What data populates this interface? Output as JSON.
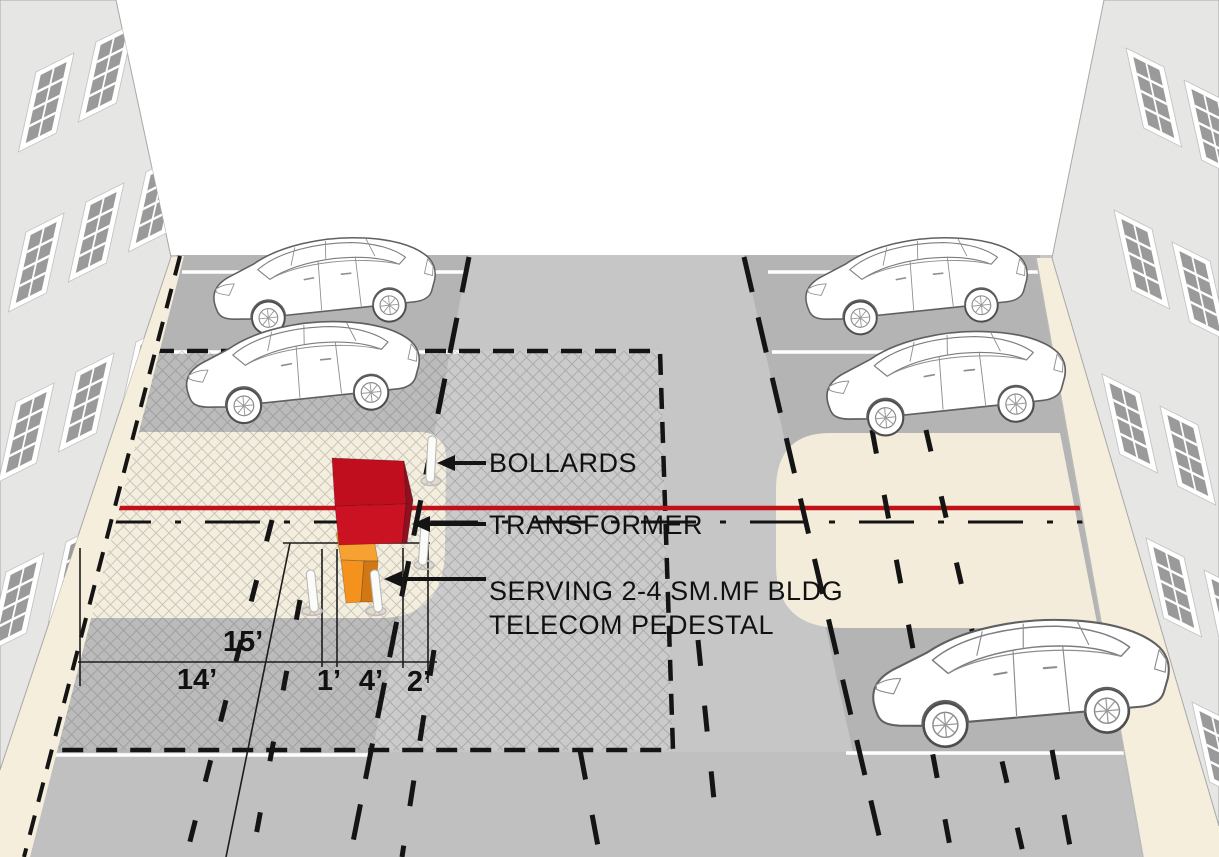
{
  "diagram": {
    "callouts": {
      "bollards": "BOLLARDS",
      "transformer": "TRANSFORMER",
      "pedestal_line1": "SERVING 2-4 SM.MF BLDG",
      "pedestal_line2": "TELECOM PEDESTAL"
    },
    "dimensions": {
      "setback_15": "15’",
      "setback_14": "14’",
      "offset_1": "1’",
      "offset_4": "4’",
      "offset_2": "2’"
    },
    "colors": {
      "transformer_top": "#c00e1f",
      "transformer_front": "#ca1222",
      "transformer_side": "#8d1120",
      "pedestal_top": "#f7a133",
      "pedestal_front": "#f5921e",
      "pedestal_side": "#d17713",
      "alignment_line": "#c01018",
      "pad_beige": "#f3ecdb",
      "sidewalk_beige": "#f5eedd",
      "street": "#c6c6c6",
      "parking_lane": "#b4b4b4",
      "building": "#e6e6e4",
      "marking_black": "#141414",
      "stall_line_white": "#ffffff"
    }
  }
}
